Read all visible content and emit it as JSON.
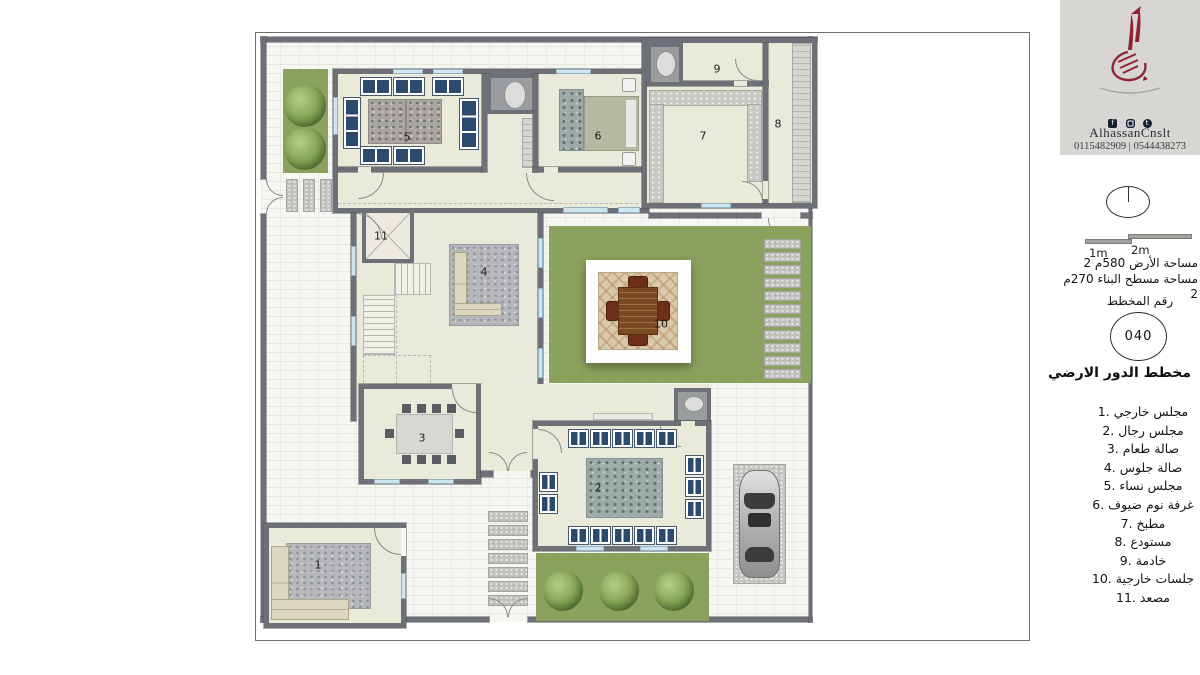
{
  "branding": {
    "name": "AlhassanCnslt",
    "phone": "0115482909 | 0544438273",
    "social_icons": [
      "facebook",
      "instagram",
      "twitter"
    ]
  },
  "title_block": {
    "scale_label_1": "1m",
    "scale_label_2": "2m",
    "area_line1": "مساحة الأرض 580م 2",
    "area_line2": "مساحة مسطح البناء 270م 2",
    "plan_number_label": "رقم المخطط",
    "plan_number": "040",
    "plan_title": "مخطط الدور الارضي"
  },
  "legend": {
    "items": [
      "1. مجلس خارجي",
      "2. مجلس رجال",
      "3. صالة طعام",
      "4. صالة جلوس",
      "5. مجلس نساء",
      "6. غرفة نوم ضيوف",
      "7. مطبخ",
      "8. مستودع",
      "9. خادمة",
      "10. جلسات خارجية",
      "11. مصعد"
    ]
  },
  "plan": {
    "labels": [
      "1",
      "2",
      "3",
      "4",
      "5",
      "6",
      "7",
      "8",
      "9",
      "10",
      "11"
    ]
  },
  "colors": {
    "logo_maroon": "#8e2434",
    "wall": "#6d7076",
    "room_floor": "#e9ead9",
    "garden_green": "#8ba25e",
    "furniture_navy": "#2c4a6e"
  }
}
